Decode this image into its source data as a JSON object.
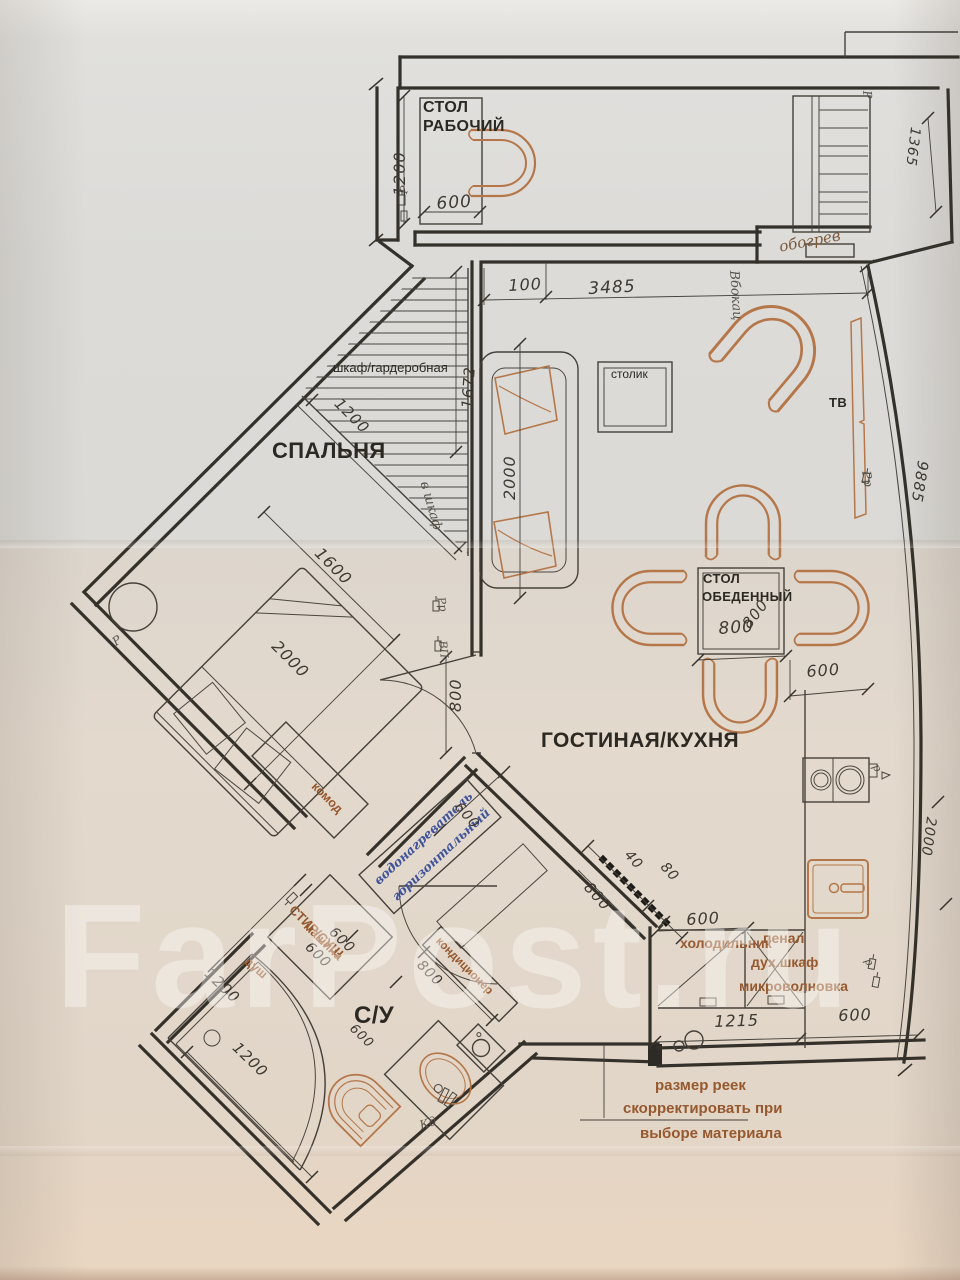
{
  "watermark": "FarPost.ru",
  "colors": {
    "ink": "#34302a",
    "furniture_accent": "#b5774a",
    "label_accent": "#96582e",
    "handwriting_blue": "#41549b",
    "handwriting_pencil": "#57524a",
    "paper_top": "#dcdbd8",
    "paper_bottom": "#e3d9cd"
  },
  "plan": {
    "labels": [
      {
        "name": "label-desk-line1",
        "text": "СТОЛ",
        "cls": "b",
        "x": 423,
        "y": 100,
        "rot": 0,
        "size": 16
      },
      {
        "name": "label-desk-line2",
        "text": "РАБОЧИЙ",
        "cls": "b",
        "x": 423,
        "y": 119,
        "rot": 0,
        "size": 16
      },
      {
        "name": "dim-1200-desk",
        "text": "1200",
        "cls": "dim",
        "x": 392,
        "y": 196,
        "rot": -90,
        "size": 16
      },
      {
        "name": "dim-600-desk",
        "text": "600",
        "cls": "dim",
        "x": 436,
        "y": 196,
        "rot": -4,
        "size": 17
      },
      {
        "name": "hand-socket-desk",
        "text": "Р",
        "cls": "hand",
        "x": 398,
        "y": 192,
        "rot": -75,
        "size": 11
      },
      {
        "name": "dim-100",
        "text": "100",
        "cls": "dim",
        "x": 508,
        "y": 278,
        "rot": -3,
        "size": 16
      },
      {
        "name": "dim-3485",
        "text": "3485",
        "cls": "dim",
        "x": 588,
        "y": 281,
        "rot": -3,
        "size": 17
      },
      {
        "name": "hand-obogrev",
        "text": "обогрев",
        "cls": "hand-brown",
        "x": 778,
        "y": 240,
        "rot": -11,
        "size": 15
      },
      {
        "name": "hand-vbok",
        "text": "Вбокац",
        "cls": "hand",
        "x": 740,
        "y": 270,
        "rot": 86,
        "size": 13
      },
      {
        "name": "hand-socket-topright",
        "text": "Р",
        "cls": "hand",
        "x": 873,
        "y": 90,
        "rot": 85,
        "size": 12
      },
      {
        "name": "label-wardrobe",
        "text": "шкаф/гардеробная",
        "cls": "",
        "x": 333,
        "y": 361,
        "rot": 0,
        "size": 13
      },
      {
        "name": "dim-1672",
        "text": "1672",
        "cls": "dim",
        "x": 460,
        "y": 408,
        "rot": -86,
        "size": 15
      },
      {
        "name": "dim-1200-wardrobe",
        "text": "1200",
        "cls": "dim",
        "x": 342,
        "y": 396,
        "rot": 45,
        "size": 15
      },
      {
        "name": "hand-vshkaf",
        "text": "в шкаф",
        "cls": "hand",
        "x": 430,
        "y": 480,
        "rot": 74,
        "size": 13
      },
      {
        "name": "label-bedroom",
        "text": "СПАЛЬНЯ",
        "cls": "b",
        "x": 272,
        "y": 440,
        "rot": 0,
        "size": 22
      },
      {
        "name": "label-stolik",
        "text": "столик",
        "cls": "",
        "x": 611,
        "y": 368,
        "rot": 0,
        "size": 12
      },
      {
        "name": "dim-2000-sofa",
        "text": "2000",
        "cls": "dim",
        "x": 502,
        "y": 500,
        "rot": -90,
        "size": 16
      },
      {
        "name": "label-tv",
        "text": "ТВ",
        "cls": "b",
        "x": 829,
        "y": 396,
        "rot": 0,
        "size": 13
      },
      {
        "name": "hand-socket-wall",
        "text": "Рр",
        "cls": "hand",
        "x": 872,
        "y": 470,
        "rot": 80,
        "size": 12
      },
      {
        "name": "dim-9885",
        "text": "9885",
        "cls": "dim",
        "x": 930,
        "y": 462,
        "rot": 99,
        "size": 15
      },
      {
        "name": "dim-1365",
        "text": "1365",
        "cls": "dim",
        "x": 922,
        "y": 128,
        "rot": 97,
        "size": 14
      },
      {
        "name": "dim-2000-right",
        "text": "2000",
        "cls": "dim",
        "x": 938,
        "y": 818,
        "rot": 98,
        "size": 14
      },
      {
        "name": "dim-1600-bed",
        "text": "1600",
        "cls": "dim",
        "x": 323,
        "y": 545,
        "rot": 45,
        "size": 16
      },
      {
        "name": "dim-2000-bed",
        "text": "2000",
        "cls": "dim",
        "x": 280,
        "y": 638,
        "rot": 45,
        "size": 16
      },
      {
        "name": "hand-socket-bedside",
        "text": "Р",
        "cls": "hand",
        "x": 110,
        "y": 638,
        "rot": -35,
        "size": 12
      },
      {
        "name": "label-komod",
        "text": "комод",
        "cls": "accent",
        "x": 318,
        "y": 780,
        "rot": 45,
        "size": 12.5
      },
      {
        "name": "dim-800-door",
        "text": "800",
        "cls": "dim",
        "x": 448,
        "y": 712,
        "rot": -90,
        "size": 16
      },
      {
        "name": "hand-socket-door1",
        "text": "Рр",
        "cls": "hand",
        "x": 446,
        "y": 596,
        "rot": 78,
        "size": 11
      },
      {
        "name": "hand-socket-door2",
        "text": "ВП",
        "cls": "hand",
        "x": 448,
        "y": 640,
        "rot": 84,
        "size": 11
      },
      {
        "name": "label-dining-line1",
        "text": "СТОЛ",
        "cls": "b",
        "x": 703,
        "y": 572,
        "rot": 0,
        "size": 13
      },
      {
        "name": "label-dining-line2",
        "text": "ОБЕДЕННЫЙ",
        "cls": "b",
        "x": 702,
        "y": 590,
        "rot": 0,
        "size": 13
      },
      {
        "name": "dim-800-dining-side",
        "text": "800",
        "cls": "dim",
        "x": 740,
        "y": 622,
        "rot": -52,
        "size": 15
      },
      {
        "name": "dim-800-dining-bottom",
        "text": "800",
        "cls": "dim",
        "x": 718,
        "y": 621,
        "rot": -4,
        "size": 17
      },
      {
        "name": "dim-600-dining",
        "text": "600",
        "cls": "dim",
        "x": 806,
        "y": 664,
        "rot": -4,
        "size": 16
      },
      {
        "name": "label-living-kitchen",
        "text": "ГОСТИНАЯ/КУХНЯ",
        "cls": "b",
        "x": 541,
        "y": 730,
        "rot": 0,
        "size": 21
      },
      {
        "name": "dim-600-fridge",
        "text": "600",
        "cls": "dim",
        "x": 686,
        "y": 912,
        "rot": -3,
        "size": 16
      },
      {
        "name": "dim-40-slats",
        "text": "40",
        "cls": "dim",
        "x": 632,
        "y": 848,
        "rot": 48,
        "size": 14
      },
      {
        "name": "dim-80-slats",
        "text": "80",
        "cls": "dim",
        "x": 668,
        "y": 860,
        "rot": 48,
        "size": 14
      },
      {
        "name": "dim-800-slats",
        "text": "800",
        "cls": "dim",
        "x": 592,
        "y": 880,
        "rot": 48,
        "size": 15
      },
      {
        "name": "label-fridge",
        "text": "холодильник",
        "cls": "accent",
        "x": 680,
        "y": 936,
        "rot": 0,
        "size": 14
      },
      {
        "name": "label-penal",
        "text": "пенал",
        "cls": "accent",
        "x": 763,
        "y": 931,
        "rot": 0,
        "size": 14
      },
      {
        "name": "label-oven",
        "text": "дух.шкаф",
        "cls": "accent",
        "x": 751,
        "y": 955,
        "rot": 0,
        "size": 14
      },
      {
        "name": "label-microwave",
        "text": "микроволновка",
        "cls": "accent",
        "x": 739,
        "y": 979,
        "rot": 0,
        "size": 14
      },
      {
        "name": "dim-1215",
        "text": "1215",
        "cls": "dim",
        "x": 714,
        "y": 1014,
        "rot": -2,
        "size": 16
      },
      {
        "name": "dim-600-kitchen",
        "text": "600",
        "cls": "dim",
        "x": 838,
        "y": 1008,
        "rot": -2,
        "size": 16
      },
      {
        "name": "note-line1",
        "text": "размер реек",
        "cls": "accent",
        "x": 655,
        "y": 1078,
        "rot": 0,
        "size": 15
      },
      {
        "name": "note-line2",
        "text": "скорректировать при",
        "cls": "accent",
        "x": 623,
        "y": 1101,
        "rot": 0,
        "size": 15
      },
      {
        "name": "note-line3",
        "text": "выборе материала",
        "cls": "accent",
        "x": 640,
        "y": 1126,
        "rot": 0,
        "size": 15
      },
      {
        "name": "hand-waterheater-line1",
        "text": "водонагреватель",
        "cls": "hand-blue",
        "x": 372,
        "y": 878,
        "rot": -43,
        "size": 12.5
      },
      {
        "name": "hand-waterheater-line2",
        "text": "горизонтальный",
        "cls": "hand-blue",
        "x": 390,
        "y": 894,
        "rot": -43,
        "size": 12.5
      },
      {
        "name": "dim-600-waterheater",
        "text": "600",
        "cls": "dim",
        "x": 462,
        "y": 800,
        "rot": 48,
        "size": 14
      },
      {
        "name": "label-washer-line1",
        "text": "СТИР/СУШ",
        "cls": "accent",
        "x": 296,
        "y": 903,
        "rot": 44,
        "size": 13
      },
      {
        "name": "label-washer-line2",
        "text": "машина",
        "cls": "accent",
        "x": 310,
        "y": 920,
        "rot": 44,
        "size": 12.5
      },
      {
        "name": "dim-600-washer1",
        "text": "600",
        "cls": "dim",
        "x": 312,
        "y": 940,
        "rot": 44,
        "size": 14
      },
      {
        "name": "dim-600-washer2",
        "text": "600",
        "cls": "dim",
        "x": 336,
        "y": 925,
        "rot": 44,
        "size": 14
      },
      {
        "name": "label-shower",
        "text": "душ",
        "cls": "accent",
        "x": 250,
        "y": 955,
        "rot": 40,
        "size": 12.5
      },
      {
        "name": "dim-1200-shower1",
        "text": "1200",
        "cls": "dim",
        "x": 212,
        "y": 966,
        "rot": 44,
        "size": 15
      },
      {
        "name": "dim-1200-shower2",
        "text": "1200",
        "cls": "dim",
        "x": 240,
        "y": 1040,
        "rot": 44,
        "size": 15
      },
      {
        "name": "label-bathroom",
        "text": "С/У",
        "cls": "b",
        "x": 354,
        "y": 1004,
        "rot": 0,
        "size": 24
      },
      {
        "name": "label-ac",
        "text": "кондиционер",
        "cls": "accent",
        "x": 441,
        "y": 936,
        "rot": 45,
        "size": 11.5
      },
      {
        "name": "dim-800-ac",
        "text": "800",
        "cls": "dim",
        "x": 424,
        "y": 958,
        "rot": 45,
        "size": 14
      },
      {
        "name": "dim-600-basin",
        "text": "600",
        "cls": "dim",
        "x": 356,
        "y": 1022,
        "rot": 44,
        "size": 13
      },
      {
        "name": "hand-kd",
        "text": "Кд",
        "cls": "hand",
        "x": 418,
        "y": 1120,
        "rot": -18,
        "size": 12
      },
      {
        "name": "hand-socket-cooktop",
        "text": "р",
        "cls": "hand",
        "x": 880,
        "y": 762,
        "rot": 60,
        "size": 11
      },
      {
        "name": "hand-socket-sink",
        "text": "р",
        "cls": "hand",
        "x": 872,
        "y": 956,
        "rot": 60,
        "size": 11
      }
    ]
  }
}
